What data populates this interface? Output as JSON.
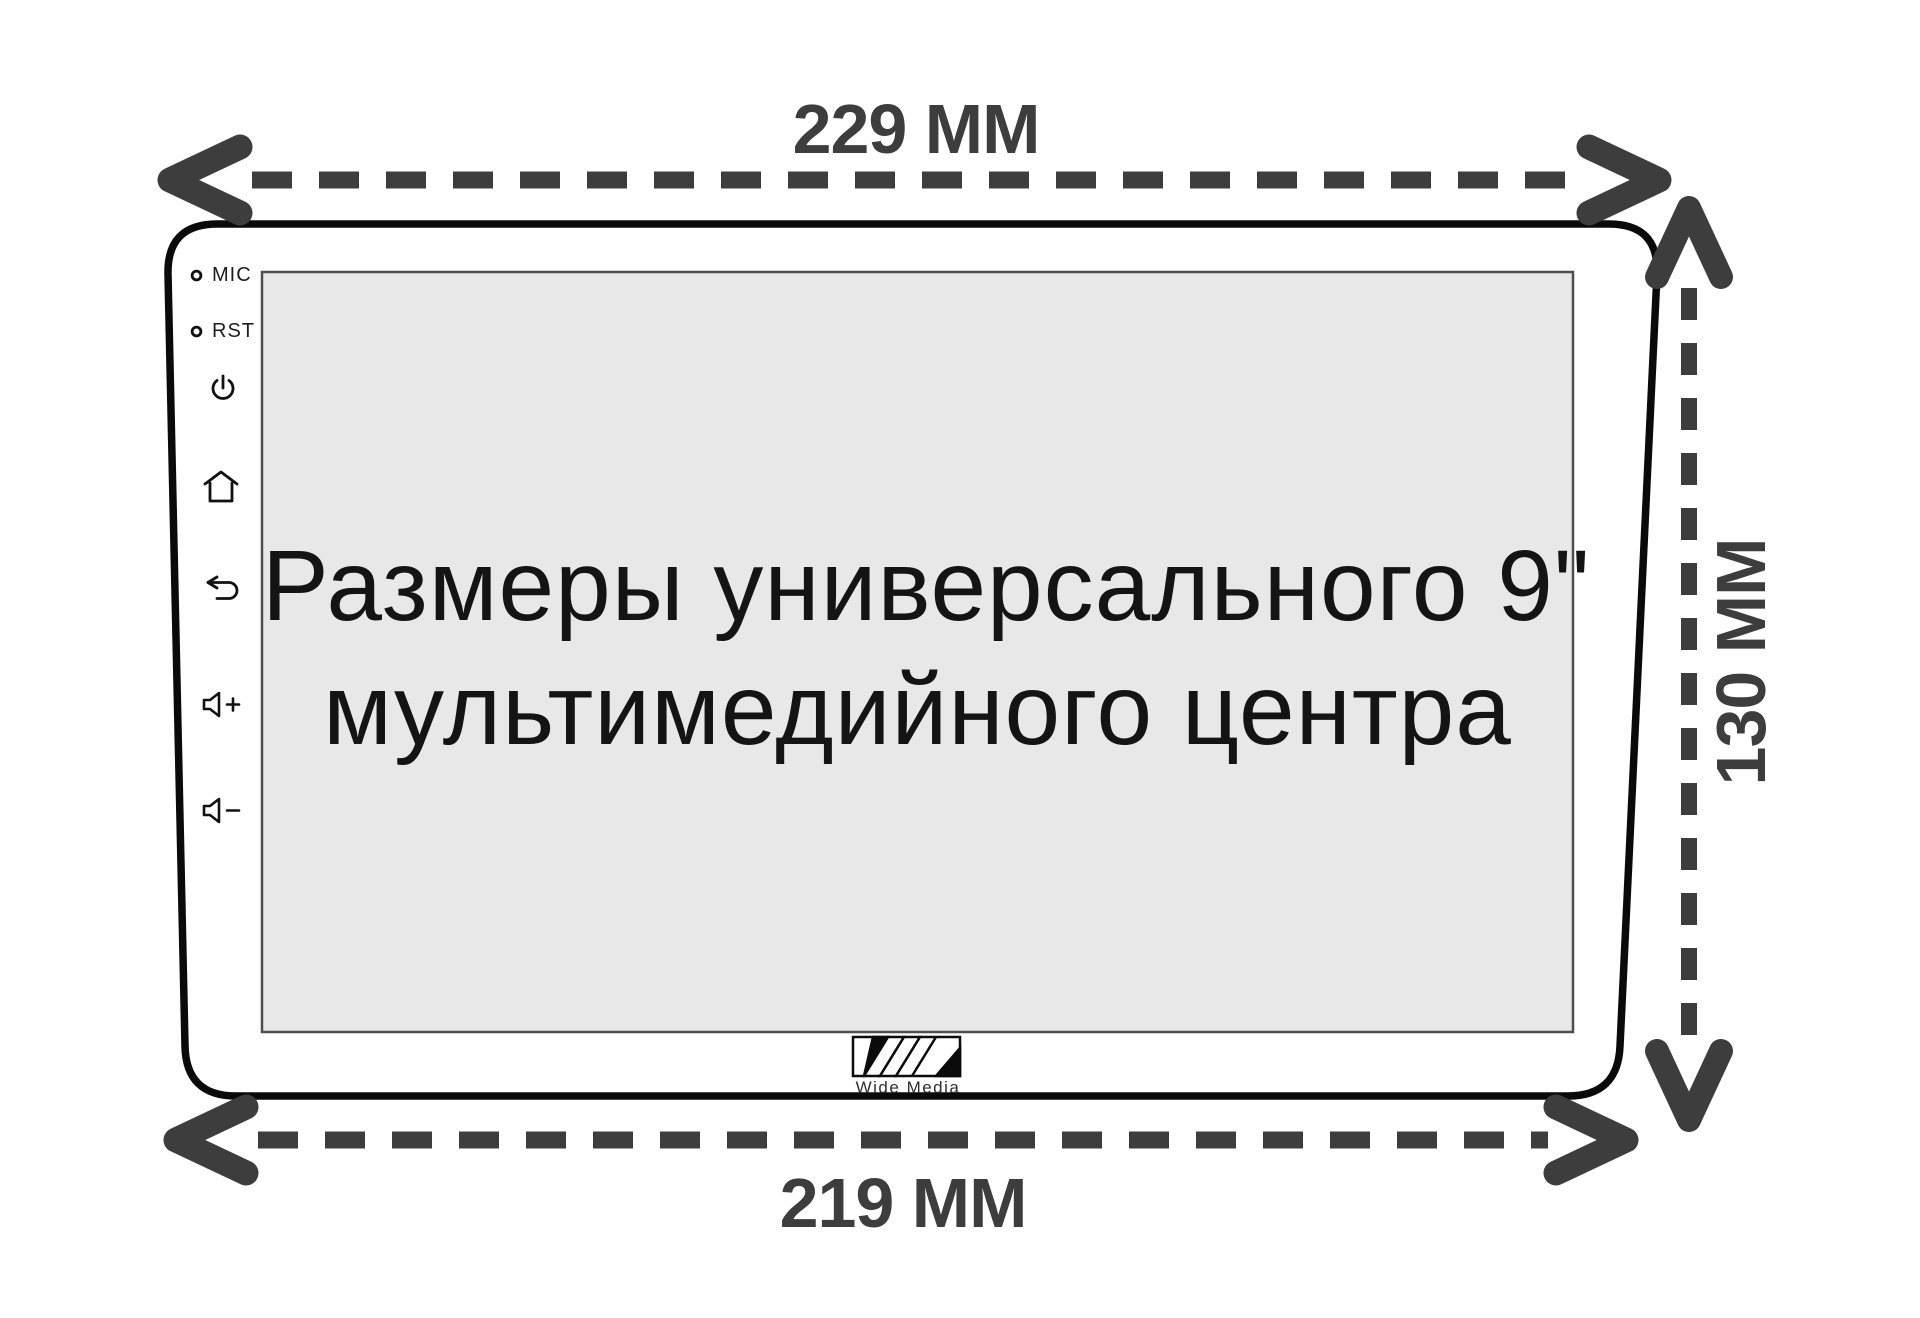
{
  "dimension_labels": {
    "top": "229 MM",
    "bottom": "219 MM",
    "side": "130 MM"
  },
  "screen_text": {
    "line1": "Размеры универсального 9\"",
    "line2": "мультимедийного центра"
  },
  "panel_controls": {
    "mic_label": "MIC",
    "reset_label": "RST"
  },
  "logo": {
    "name": "Wide Media"
  },
  "colors": {
    "dimension_arrow": "#3d3d3d",
    "device_outline": "#0a0a0a",
    "screen_fill": "#e8e8e8",
    "screen_border": "#4d4d4d",
    "screen_text": "#141414",
    "background": "#ffffff"
  }
}
